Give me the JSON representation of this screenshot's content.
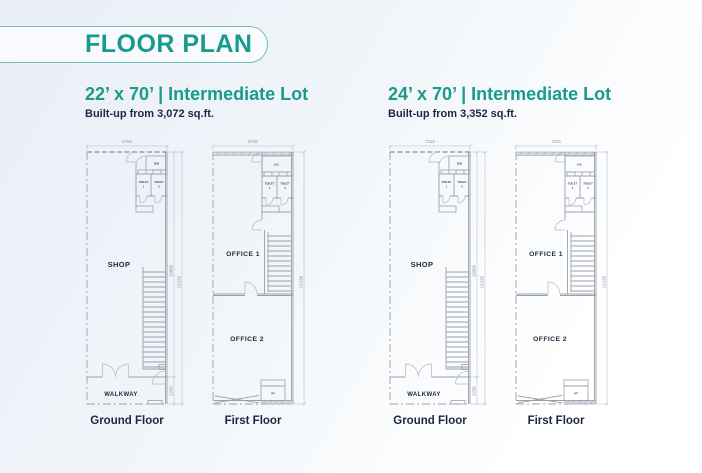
{
  "header": {
    "title": "FLOOR PLAN"
  },
  "colors": {
    "teal": "#189b8c",
    "navy": "#1d2742",
    "plan_line": "#9aa0ab",
    "dim_text": "#8d929c",
    "bg_top": "#e9eef7",
    "bg_bottom": "#ffffff"
  },
  "lots": [
    {
      "title": "22’ x 70’ | Intermediate Lot",
      "builtup": "Built-up from 3,072 sq.ft.",
      "ground": {
        "caption": "Ground Floor",
        "width_dim": "6706",
        "depth_dim": "19086",
        "total_dim": "21336",
        "walkway_dim": "2250",
        "shop": "SHOP",
        "walkway": "WALKWAY",
        "bin": "BIN",
        "toilet_word": "TOILET",
        "toilet1_num": "1",
        "toilet2_num": "2"
      },
      "first": {
        "caption": "First Floor",
        "width_dim": "6706",
        "total_dim": "21336",
        "office1": "OFFICE 1",
        "office2": "OFFICE 2",
        "ac_top": "A/C",
        "ac_bottom": "a/c",
        "toilet_word": "TOILET",
        "toilet1_num": "1",
        "toilet2_num": "2"
      }
    },
    {
      "title": "24’ x 70’ | Intermediate Lot",
      "builtup": "Built-up from 3,352 sq.ft.",
      "ground": {
        "caption": "Ground Floor",
        "width_dim": "7315",
        "depth_dim": "19086",
        "total_dim": "21336",
        "walkway_dim": "2250",
        "shop": "SHOP",
        "walkway": "WALKWAY",
        "bin": "BIN",
        "toilet_word": "TOILET",
        "toilet1_num": "1",
        "toilet2_num": "2"
      },
      "first": {
        "caption": "First Floor",
        "width_dim": "7315",
        "total_dim": "21336",
        "office1": "OFFICE 1",
        "office2": "OFFICE 2",
        "ac_top": "A/C",
        "ac_bottom": "a/c",
        "toilet_word": "TOILET",
        "toilet1_num": "1",
        "toilet2_num": "2"
      }
    }
  ]
}
